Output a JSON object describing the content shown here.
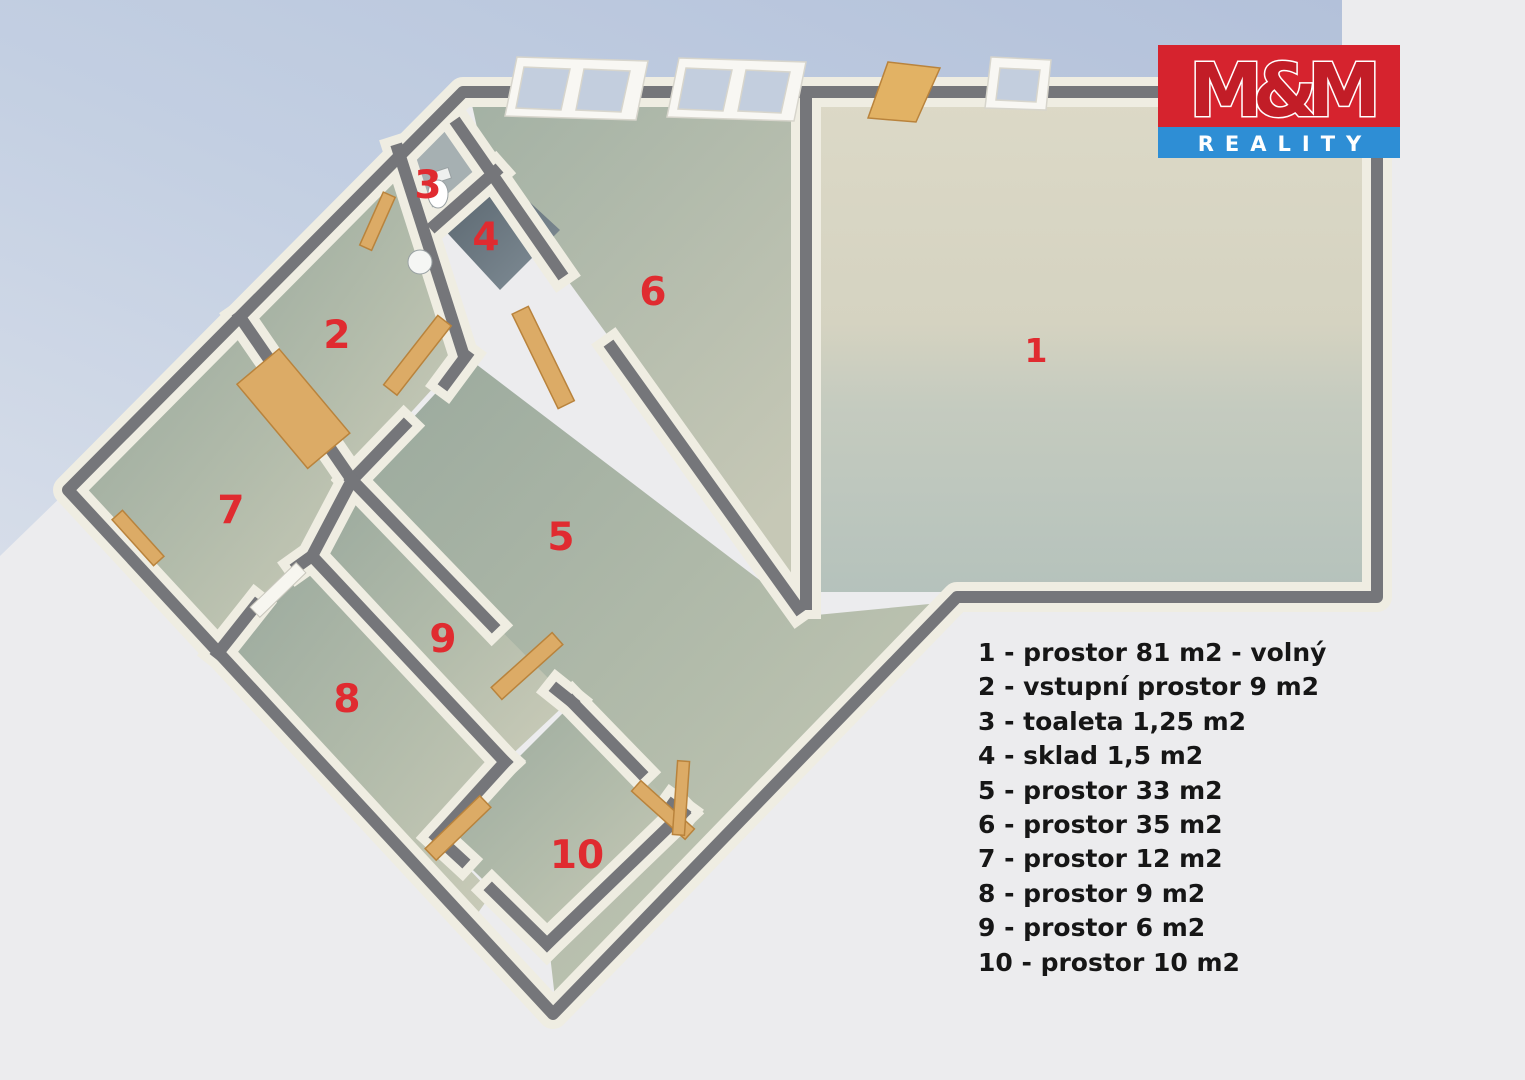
{
  "page": {
    "background": "#ececee",
    "shadow_color": "#b8c5dc"
  },
  "logo": {
    "title": "M&M",
    "subtitle": "REALITY",
    "red": "#d6232e",
    "m_red": "#c21d27",
    "blue": "#2e8ed5",
    "text_white": "#ffffff"
  },
  "plan": {
    "label_color": "#e02b30",
    "wall_color": "#75767a",
    "wall_face_color": "#efede2",
    "labels": [
      {
        "room": "1",
        "text": "1"
      },
      {
        "room": "2",
        "text": "2"
      },
      {
        "room": "3",
        "text": "3"
      },
      {
        "room": "4",
        "text": "4"
      },
      {
        "room": "5",
        "text": "5"
      },
      {
        "room": "6",
        "text": "6"
      },
      {
        "room": "7",
        "text": "7"
      },
      {
        "room": "8",
        "text": "8"
      },
      {
        "room": "9",
        "text": "9"
      },
      {
        "room": "10",
        "text": "10"
      }
    ]
  },
  "legend": {
    "items": [
      "1 - prostor 81 m2 - volný",
      "2 - vstupní prostor 9 m2",
      "3 - toaleta 1,25 m2",
      "4 - sklad 1,5 m2",
      "5 - prostor 33 m2",
      "6 - prostor 35 m2",
      "7 - prostor 12 m2",
      "8 - prostor 9 m2",
      "9 - prostor 6 m2",
      "10 - prostor 10 m2"
    ]
  }
}
